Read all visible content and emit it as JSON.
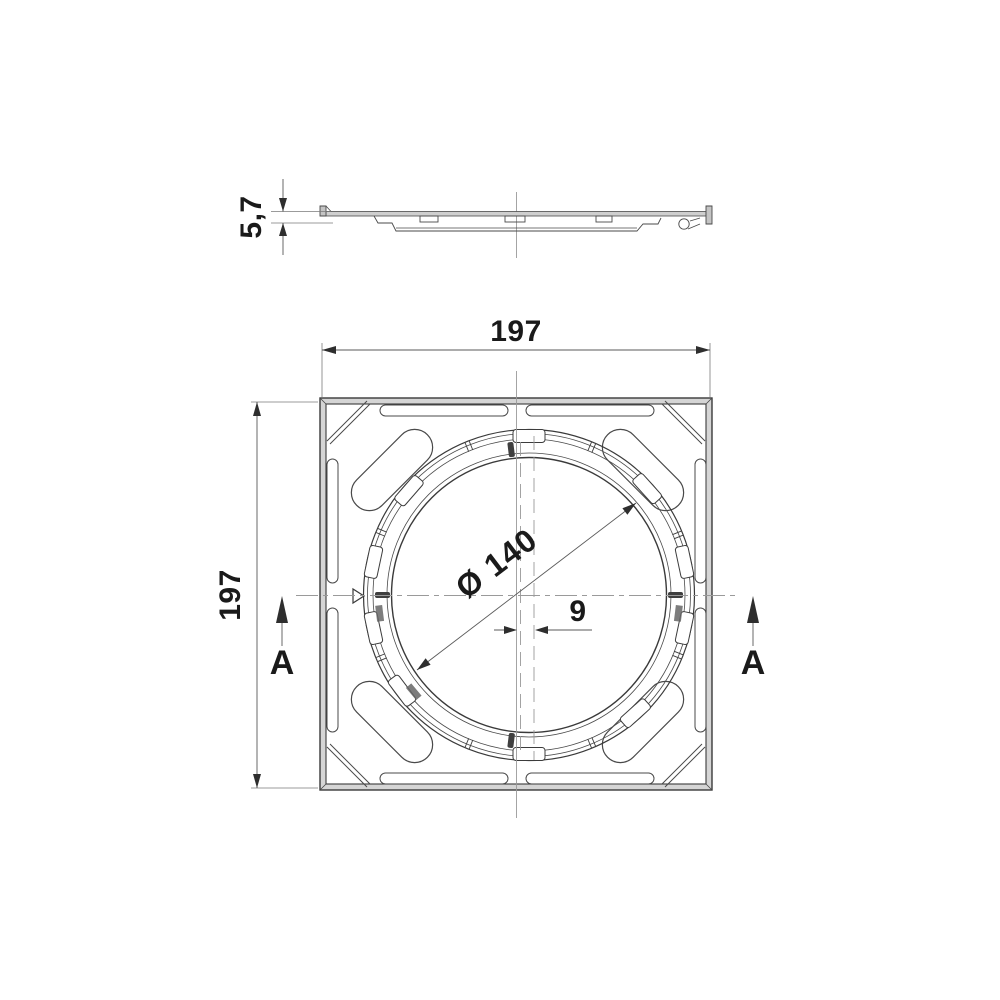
{
  "drawing": {
    "type": "technical-drawing",
    "views": {
      "profile_view": "side profile section of cover",
      "plan_view": "top plan view of square cover with circular seat"
    },
    "dimensions": {
      "overall_width": "197",
      "overall_height": "197",
      "profile_thickness": "5,7",
      "opening_diameter": "Ø 140",
      "center_offset": "9"
    },
    "section_markers": {
      "left_label": "A",
      "right_label": "A"
    },
    "colors": {
      "background": "#ffffff",
      "main_line": "#3a3a3a",
      "dimension_line": "#5a5a5a",
      "centerline": "#9a9a9a",
      "edge_fill": "#d5d5d5",
      "text": "#1a1a1a"
    }
  }
}
